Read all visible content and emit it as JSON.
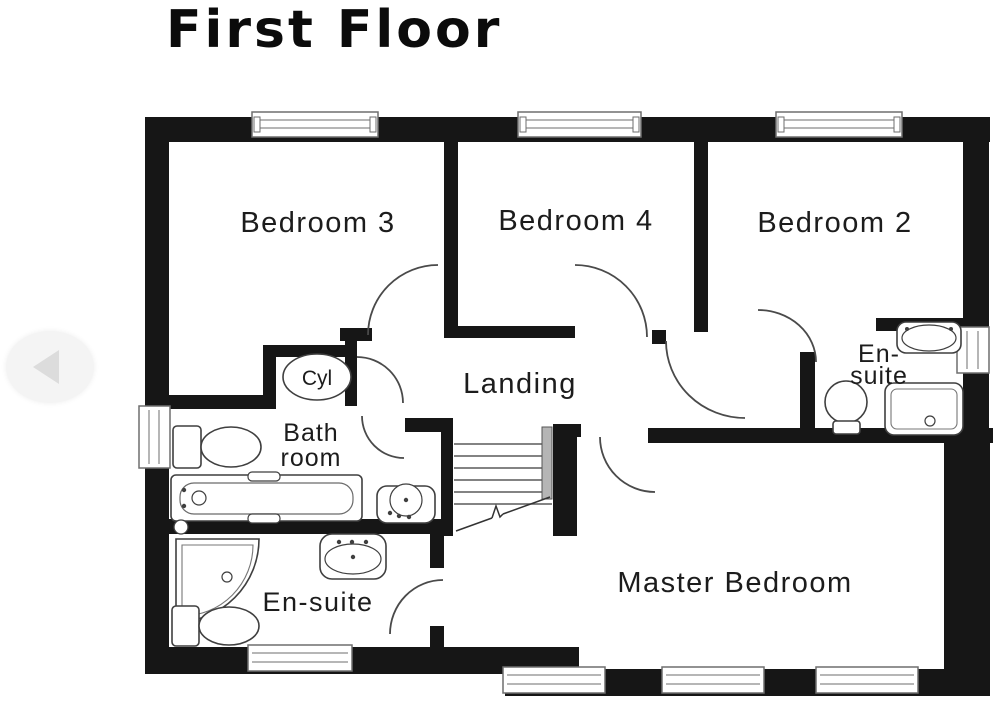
{
  "page": {
    "background": "#ffffff"
  },
  "header": {
    "title": "First Floor"
  },
  "nav": {
    "back_icon": "left-arrow"
  },
  "floorplan": {
    "rooms": {
      "bedroom3": {
        "label": "Bedroom 3"
      },
      "bedroom4": {
        "label": "Bedroom 4"
      },
      "bedroom2": {
        "label": "Bedroom 2"
      },
      "landing": {
        "label": "Landing"
      },
      "cylinder": {
        "label": "Cyl"
      },
      "bathroom": {
        "line1": "Bath",
        "line2": "room"
      },
      "ensuite_top": {
        "line1": "En-",
        "line2": "suite"
      },
      "ensuite_bottom": {
        "label": "En-suite"
      },
      "master": {
        "label": "Master Bedroom"
      }
    },
    "fixtures": [
      "bath",
      "toilet",
      "wash-basin",
      "pedestal-sink",
      "shower-tray",
      "corner-shower",
      "hot-water-cylinder",
      "stairs"
    ],
    "colors": {
      "wall": "#161616",
      "window_frame": "#6e6e6e",
      "fixture_stroke": "#3f3f3f",
      "door_arc": "#4a4a4a",
      "label": "#1c1c1c",
      "nav_button": "#f4f4f4",
      "nav_arrow": "#dcdcdc"
    }
  }
}
